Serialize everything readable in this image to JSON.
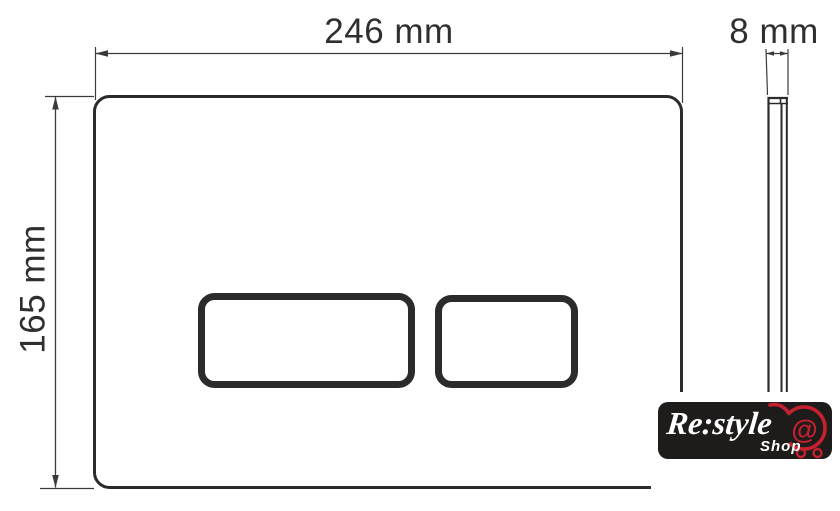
{
  "drawing": {
    "type": "technical-dimension-drawing",
    "subject": "flush-plate-front-and-side-view",
    "dimensions": {
      "width": "246 mm",
      "height": "165 mm",
      "depth": "8 mm"
    },
    "colors": {
      "outline": "#2b2b2b",
      "dim_line": "#3a3a3a",
      "text": "#2f2f2f",
      "background": "#ffffff"
    }
  },
  "logo": {
    "brand": "Re:style",
    "shop": "Shop",
    "at": "@",
    "colors": {
      "bg": "#1e1c1b",
      "text": "#ffffff",
      "accent": "#c4202f"
    }
  }
}
